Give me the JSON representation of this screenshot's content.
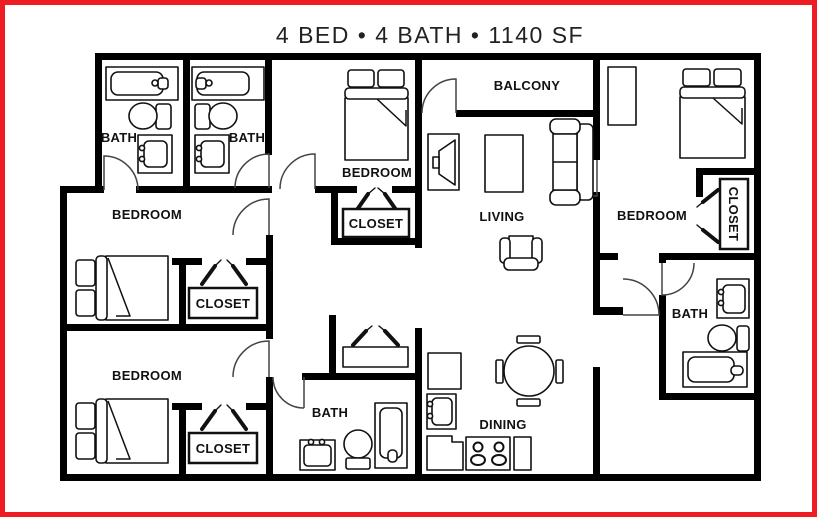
{
  "plan": {
    "title": "4 BED • 4 BATH • 1140 SF",
    "rooms": {
      "bath_top_left": "BATH",
      "bath_top_middle": "BATH",
      "bath_middle_right": "BATH",
      "bath_bottom_middle": "BATH",
      "bedroom_top_middle": "BEDROOM",
      "bedroom_middle_left": "BEDROOM",
      "bedroom_bottom_left": "BEDROOM",
      "bedroom_right": "BEDROOM",
      "balcony": "BALCONY",
      "living": "LIVING",
      "dining": "DINING",
      "closet_top_middle": "CLOSET",
      "closet_middle_left": "CLOSET",
      "closet_bottom_left": "CLOSET",
      "closet_right": "CLOSET"
    },
    "colors": {
      "border": "#ee1c23",
      "walls": "#000000",
      "fixtures": "#111111",
      "background": "#ffffff"
    },
    "icons": [
      "bathtub-icon",
      "toilet-icon",
      "sink-icon",
      "shower-icon",
      "double-bed-icon",
      "clothes-hanger-icon",
      "closet-shelf-icon",
      "dresser-icon",
      "tv-icon",
      "coffee-table-icon",
      "sofa-icon",
      "armchair-icon",
      "dining-table-icon",
      "dining-chair-icon",
      "refrigerator-icon",
      "kitchen-sink-icon",
      "stove-icon",
      "kitchen-counter-icon",
      "door-swing-icon"
    ]
  }
}
